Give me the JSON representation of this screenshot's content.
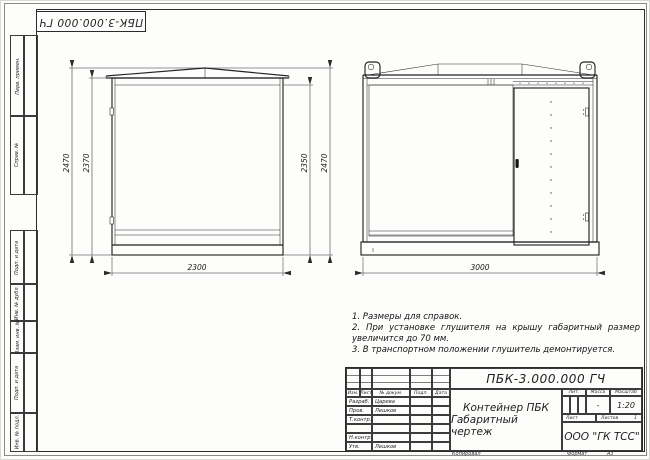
{
  "stamp": {
    "doc_number_rotated": "ПБК-3.000.000 ГЧ"
  },
  "frame": {
    "labels": [
      "Перв. примен.",
      "Справ. №",
      "Подп. и дата",
      "Инв. № дубл.",
      "Взам. инв. №",
      "Подп. и дата",
      "Инв. № подл."
    ]
  },
  "dimensions": {
    "side_left_outer": "2470",
    "side_left_inner": "2370",
    "side_right_inner": "2350",
    "side_right_outer": "2470",
    "side_width": "2300",
    "front_width": "3000"
  },
  "notes": [
    "1. Размеры для справок.",
    "2. При установке глушителя на крышу габаритный размер увеличится до 70 мм.",
    "3. В транспортном положении глушитель демонтируется."
  ],
  "title_block": {
    "doc_number": "ПБК-3.000.000 ГЧ",
    "product_name": "Контейнер ПБК",
    "doc_type": "Габаритный чертеж",
    "columns": [
      "Изм.",
      "Лист",
      "№ докум.",
      "Подп.",
      "Дата"
    ],
    "rows": [
      {
        "role": "Разраб.",
        "name": "Царева"
      },
      {
        "role": "Пров.",
        "name": "Лешков"
      },
      {
        "role": "Т.контр.",
        "name": ""
      },
      {
        "role": "",
        "name": ""
      },
      {
        "role": "Н.контр.",
        "name": ""
      },
      {
        "role": "Утв.",
        "name": "Лешков"
      }
    ],
    "lit_label": "Лит.",
    "mass_label": "Масса",
    "mass_value": "-",
    "scale_label": "Масштаб",
    "scale_value": "1:20",
    "sheet_label": "Лист",
    "sheets_label": "Листов",
    "sheets_value": "1",
    "company": "ООО \"ГК ТСС\"",
    "copied_label": "Копировал",
    "format_label": "Формат",
    "format_value": "А3"
  }
}
